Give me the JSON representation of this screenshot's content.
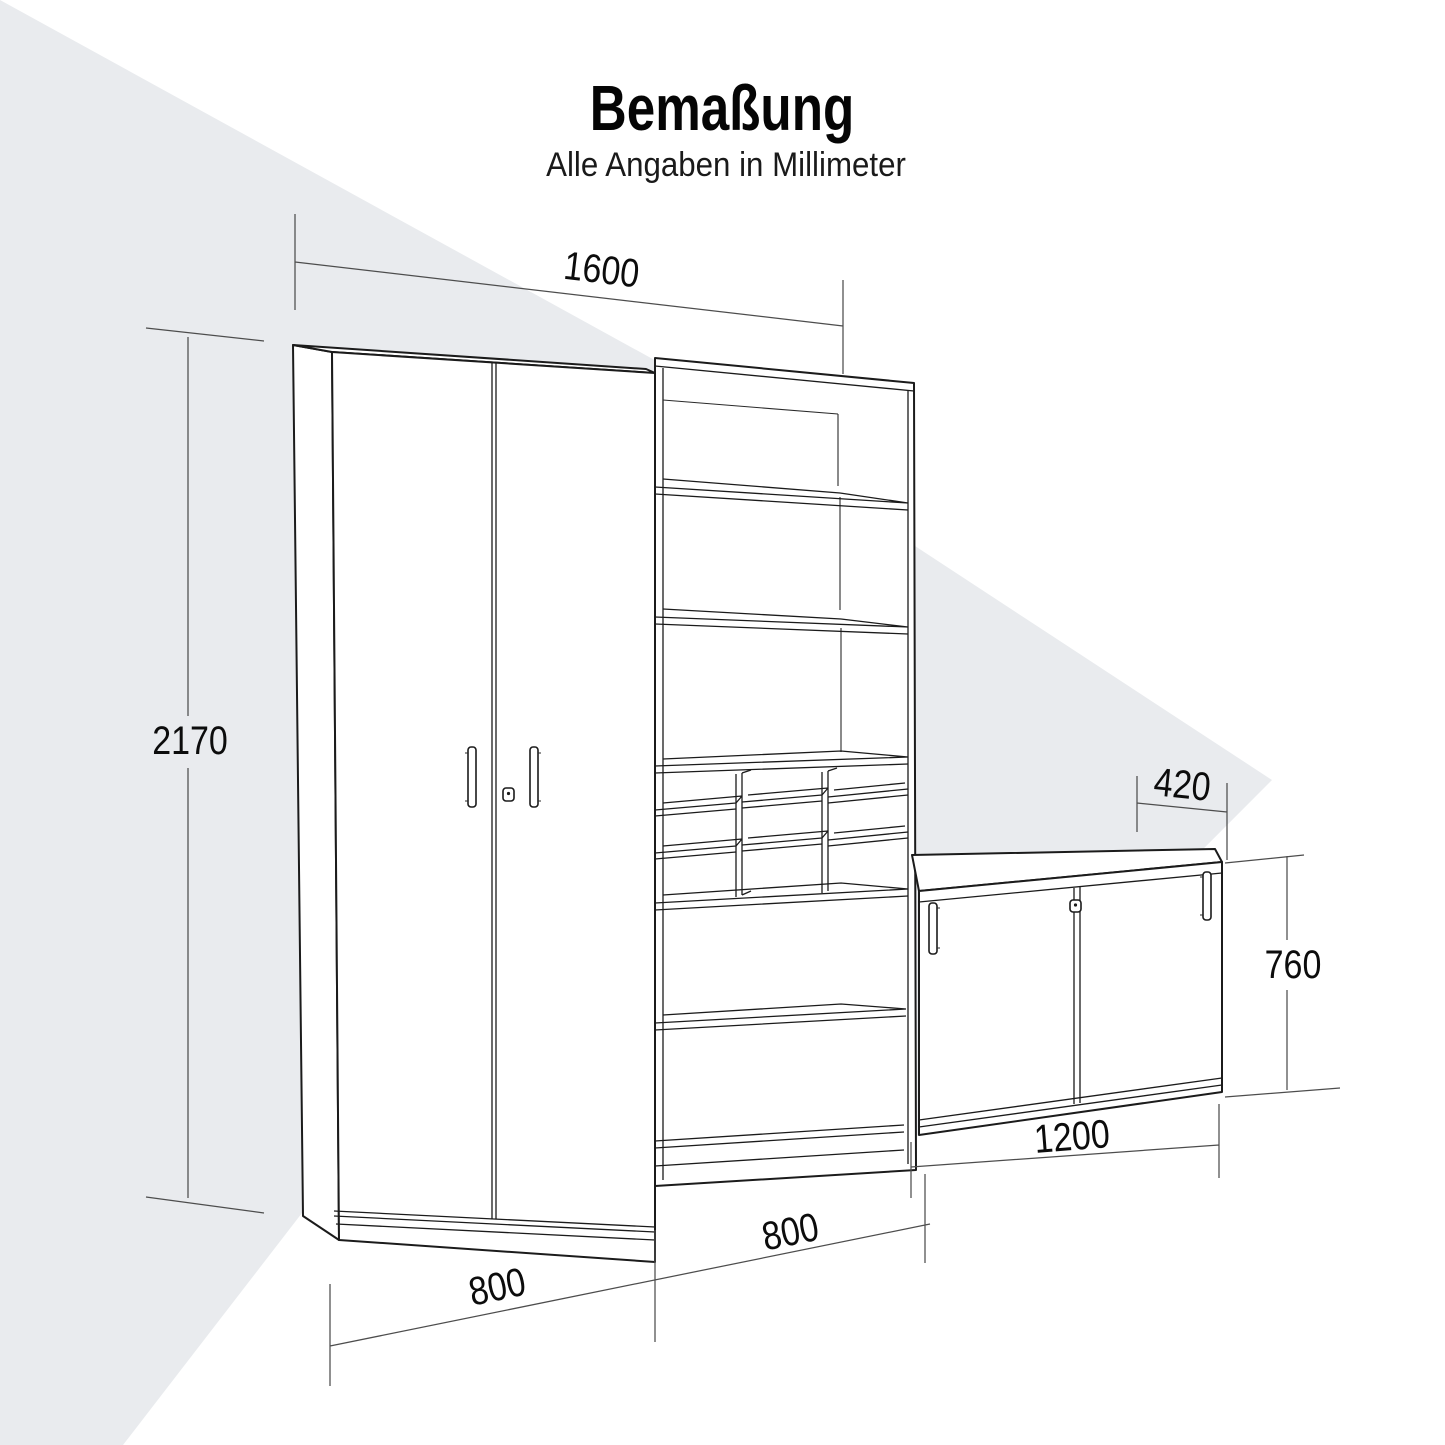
{
  "header": {
    "title": "Bemaßung",
    "subtitle": "Alle Angaben in Millimeter"
  },
  "units": "mm",
  "dimension_labels": {
    "total_width": "1600",
    "total_height": "2170",
    "sideboard_depth": "420",
    "sideboard_height": "760",
    "sideboard_width": "1200",
    "shelf_unit_width": "800",
    "cabinet_width": "800"
  },
  "colors": {
    "background": "#ffffff",
    "shade_triangle": "#e9ebee",
    "outline": "#1b1b1b",
    "dimension_line": "#4d4d4d",
    "text": "#0c0c0c"
  }
}
